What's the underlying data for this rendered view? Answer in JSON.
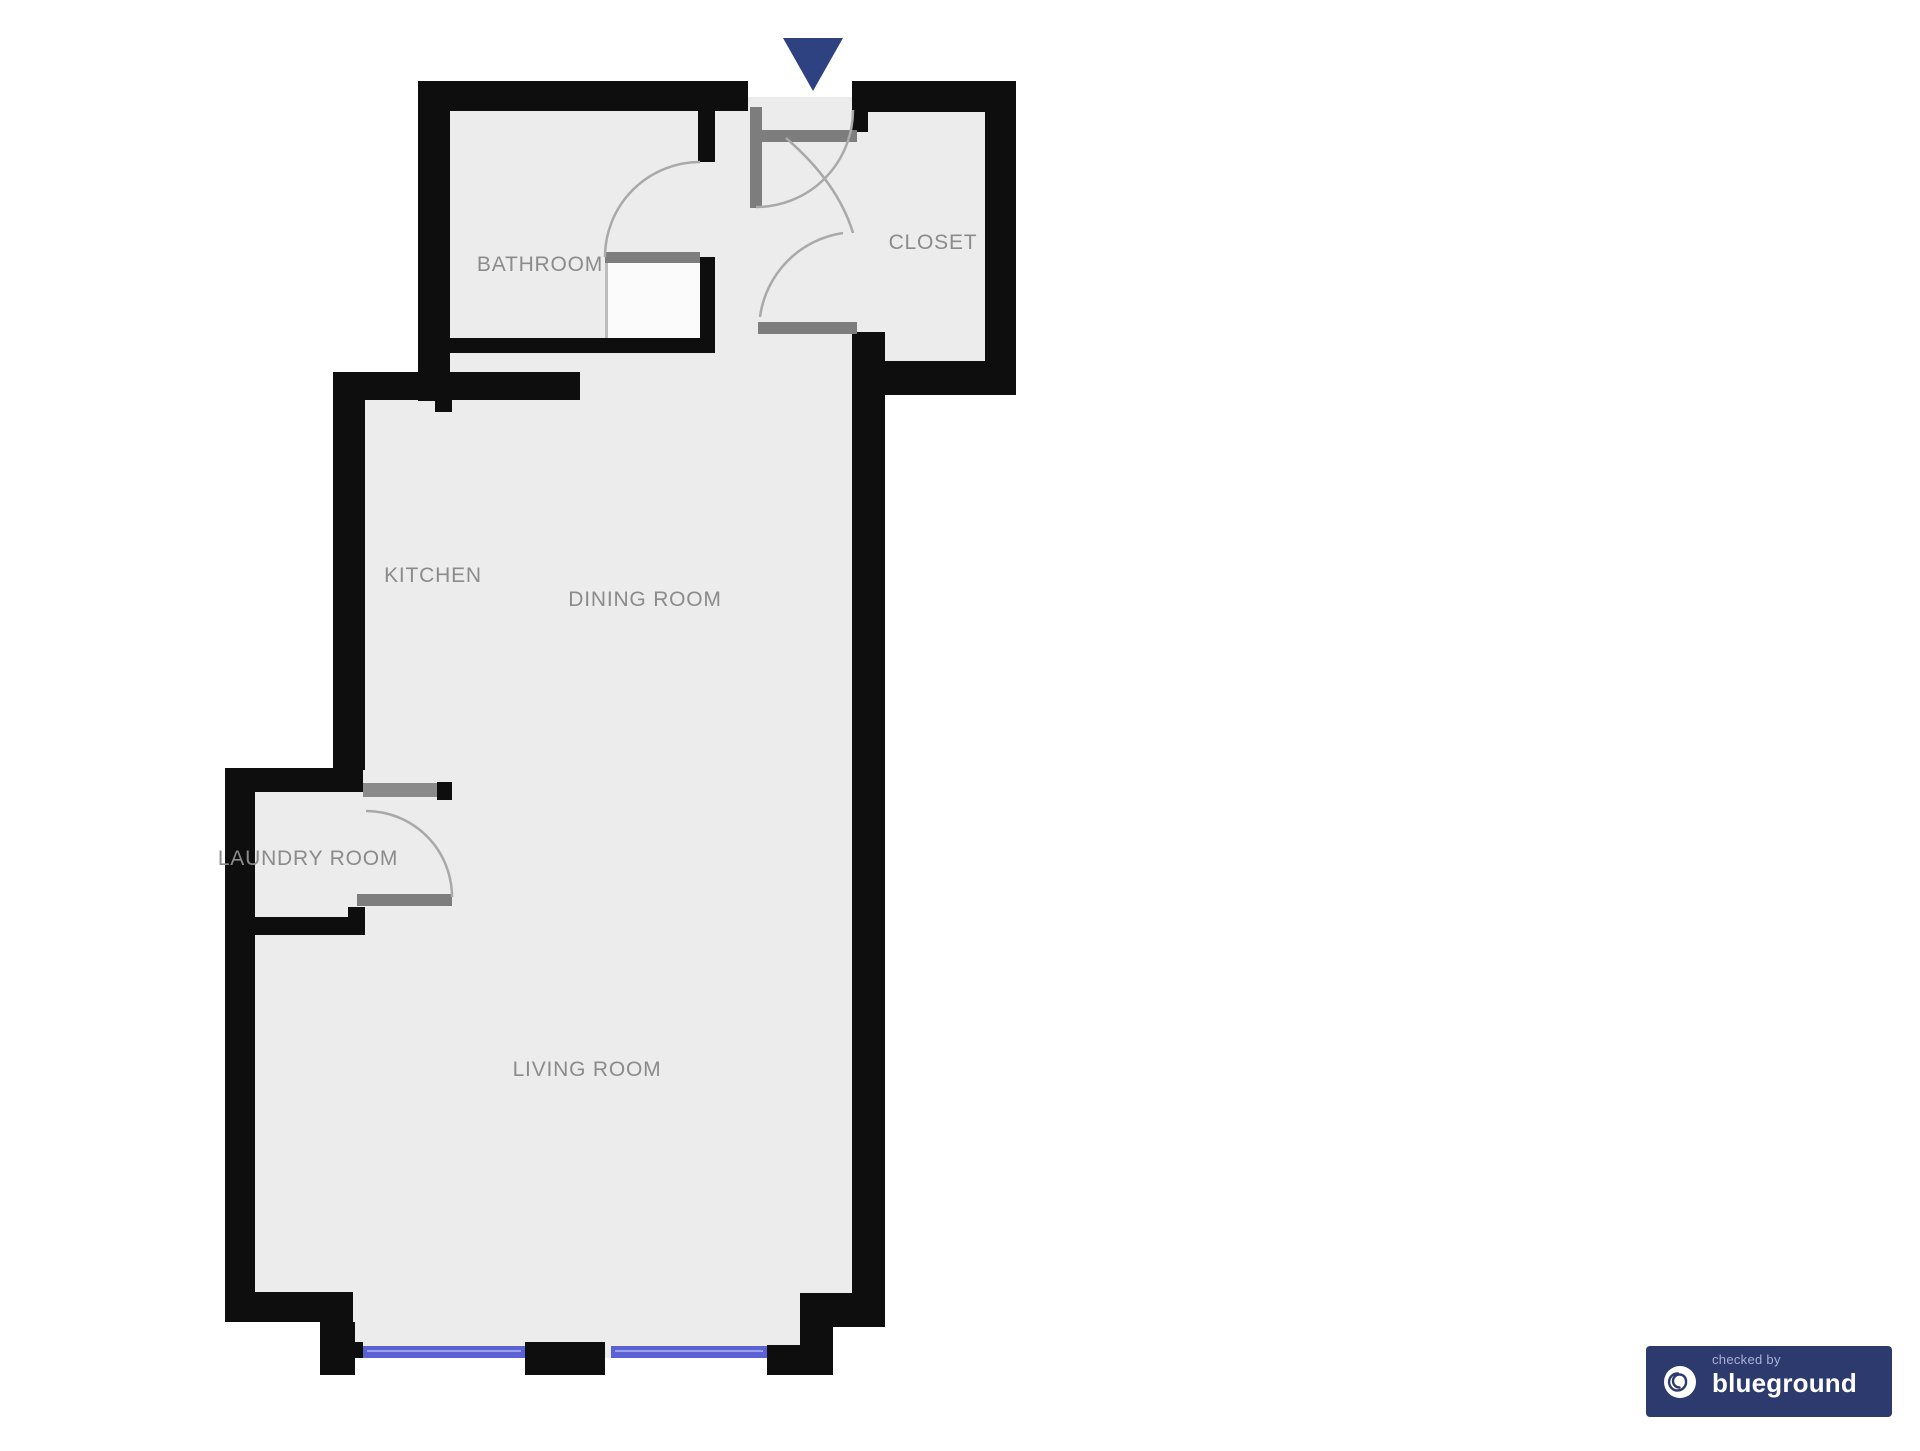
{
  "floorplan": {
    "rooms": [
      {
        "id": "bathroom",
        "label": "BATHROOM"
      },
      {
        "id": "closet",
        "label": "CLOSET"
      },
      {
        "id": "kitchen",
        "label": "KITCHEN"
      },
      {
        "id": "dining-room",
        "label": "DINING ROOM"
      },
      {
        "id": "laundry-room",
        "label": "LAUNDRY ROOM"
      },
      {
        "id": "living-room",
        "label": "LIVING ROOM"
      }
    ],
    "entrance_marker": {
      "color": "#2e4180"
    },
    "colors": {
      "wall": "#0e0e0e",
      "floor": "#ececec",
      "door_leaf": "#7d7d7d",
      "door_arc": "#a9a9a9",
      "window": "#5a62d3",
      "label_text": "#8b8b8b",
      "shower": "#fbfbfb"
    }
  },
  "badge": {
    "checked_by": "checked by",
    "brand": "blueground",
    "background": "#2d3a6e",
    "brand_color": "#ffffff",
    "subtext_color": "#a9b2d6"
  }
}
